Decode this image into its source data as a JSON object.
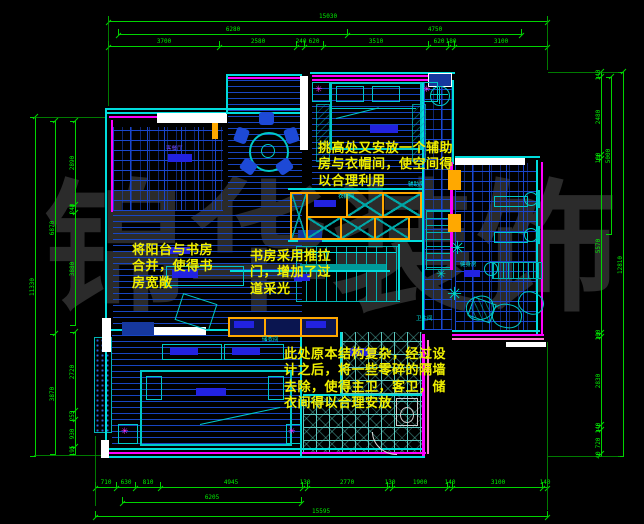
{
  "watermark": "锦华装饰",
  "colors": {
    "background": "#000000",
    "dimension_green": "#00ee00",
    "wall_cyan": "#00dcdc",
    "wall_magenta": "#ff00ff",
    "wall_white": "#ffffff",
    "cabinet_orange": "#ffa800",
    "floor_blue": "#1946cd",
    "annotation_yellow": "#f0f000",
    "label_blue_fill": "#2222e0",
    "watermark_gray": "#2b2b2b"
  },
  "dims": {
    "top": {
      "overall": "15030",
      "row2": [
        "6280",
        "4750"
      ],
      "chain": [
        "3700",
        "2580",
        "240",
        "620",
        "3510",
        "620",
        "180",
        "3100"
      ]
    },
    "bottom": {
      "chain": [
        "710",
        "630",
        "810",
        "4945",
        "130",
        "2770",
        "130",
        "1900",
        "140",
        "3100",
        "140"
      ],
      "mid": "6205",
      "overall": "15595"
    },
    "left": {
      "overall": "11330",
      "row2": [
        "6870",
        "3870"
      ],
      "chain_upper": [
        "2890",
        "240",
        "3880"
      ],
      "chain_lower": [
        "2720",
        "255",
        "930",
        "195"
      ]
    },
    "right": {
      "overall": "12810",
      "secondary": "5000",
      "chain": [
        "140",
        "2480",
        "100",
        "5570",
        "100",
        "2830",
        "140",
        "720",
        "40"
      ]
    }
  },
  "annotations": {
    "note1": "挑高处又安放一个辅助房与衣帽间，使空间得以合理利用",
    "note2": "将阳台与书房合并，使得书房宽敞",
    "note3": "书房采用推拉门，增加了过道采光",
    "note4": "此处原本结构复杂，经过设计之后，将一些零碎的隔墙去除，使得主卫，客卫，储衣间得以合理安放"
  },
  "room_labels": {
    "foyer": "客餐厅",
    "closet": "衣帽间",
    "aux": "辅助房",
    "gym": "健身房",
    "bath": "卫生间",
    "storage": "储衣间"
  }
}
